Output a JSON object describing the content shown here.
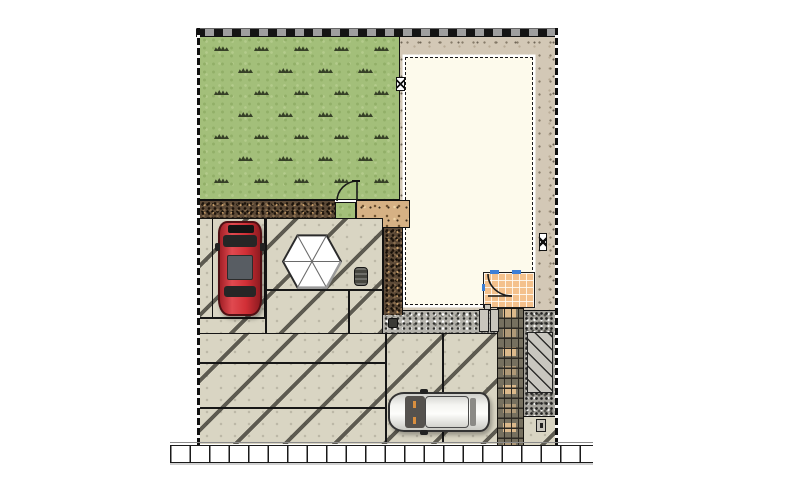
{
  "scene": {
    "type": "landscape-site-plan",
    "visible_text": [],
    "features": [
      "lawn",
      "boundary-wall",
      "dwelling-footprint",
      "perimeter-gravel",
      "entrance-porch-tiled",
      "entrance-door-swing",
      "garden-gate-swing",
      "tiled-approach-path",
      "planting-bed-dark-gravel",
      "planting-bed-sand",
      "shrub-square",
      "concrete-parking-court",
      "expansion-joints-diagonal",
      "red-car",
      "white-car",
      "hexagonal-parasol-table",
      "flower-pot",
      "utility-meters",
      "water-meter-markers",
      "service-yard-gravel",
      "hatched-service-rect",
      "mail-meter-box",
      "public-sidewalk-tiles"
    ]
  },
  "colors": {
    "lawn": "#a3bf7a",
    "building_fill": "#fdfaec",
    "gravel_tan": "#d3c8b6",
    "bed_sand": "#d6b184",
    "bed_dark": "#5d4a37",
    "gravel_gray": "#b4b2ab",
    "gravel_dark": "#a5a39c",
    "concrete": "#d9d5c3",
    "porch_tile": "#f4c18c",
    "walkway_dark": "#76705f",
    "walkway_tan": "#dcb98b",
    "hatch_fill": "#c9c7c0",
    "sidewalk": "#ffffff",
    "wall_gray": "#9e9e9e",
    "car_red": "#d12f36",
    "car_white": "#f4f4f1",
    "glass_dark": "#262626",
    "door_blue": "#3d7fd6"
  },
  "lawn": {
    "tuft_rows": 7,
    "tufts_even_row": [
      14,
      54,
      94,
      134,
      174
    ],
    "tufts_odd_row": [
      38,
      78,
      118,
      158
    ]
  }
}
